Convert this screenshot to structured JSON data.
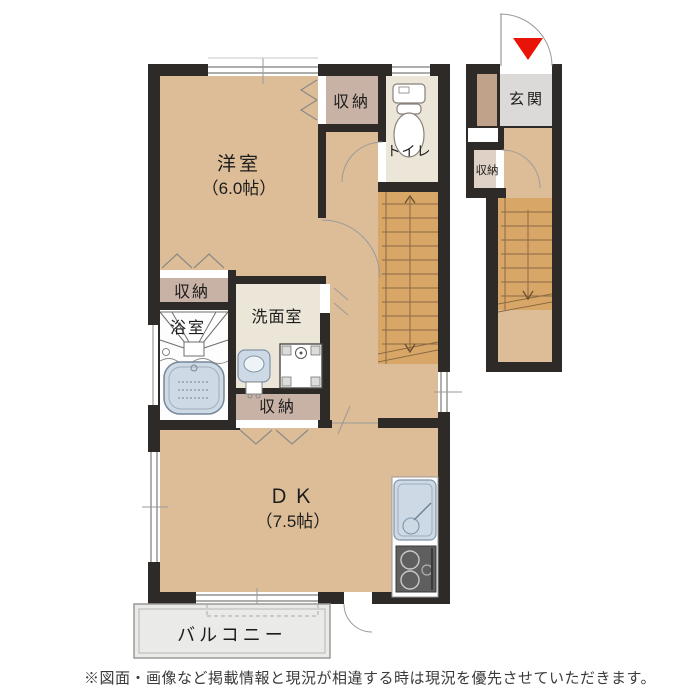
{
  "plan": {
    "type": "floor-plan",
    "disclaimer": "※図面・画像など掲載情報と現況が相違する時は現況を優先させていただきます。",
    "rooms": {
      "western_room": {
        "name": "洋室",
        "size": "（6.0帖）"
      },
      "dining_kitchen": {
        "name": "ＤＫ",
        "size": "（7.5帖）"
      },
      "toilet": {
        "name": "トイレ"
      },
      "bath": {
        "name": "浴室"
      },
      "washroom": {
        "name": "洗面室"
      },
      "closet_top": {
        "name": "収納"
      },
      "closet_mid": {
        "name": "収納"
      },
      "closet_low": {
        "name": "収納"
      },
      "balcony": {
        "name": "バルコニー"
      },
      "entrance": {
        "name": "玄関"
      },
      "entrance_closet": {
        "name": "収納"
      }
    }
  },
  "colors": {
    "wall": "#2d2a28",
    "room_tan": "#dcbd98",
    "closet_beige": "#c8b2a6",
    "service_cream": "#ece6d8",
    "bath_white": "#fdfdfd",
    "entrance_gray": "#dbdad8",
    "entrance_closet_beige": "#e0d1c7",
    "shoe_cabinet": "#bfa289",
    "stairs": "#d8a768",
    "balcony_gray": "#eaeae8",
    "fixture_blue": "#cdd9e4",
    "stove_gray": "#5f5f5f",
    "entrance_marker_red": "#e81407"
  }
}
